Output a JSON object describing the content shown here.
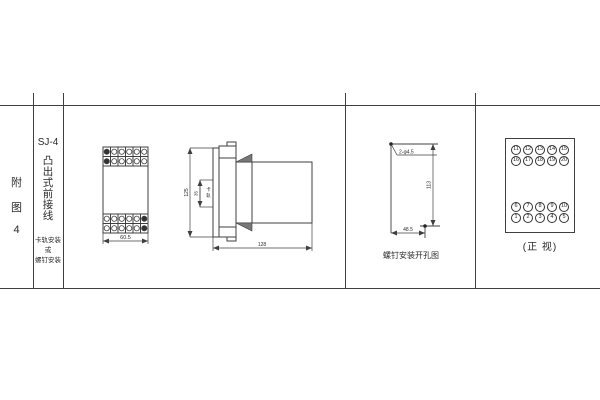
{
  "window": {
    "background": "#ffffff",
    "line_color": "#3f3f3f"
  },
  "sidebar": {
    "figure_label_chars": [
      "附",
      "图",
      "4"
    ],
    "model": "SJ-4",
    "type_chars": [
      "凸",
      "出",
      "式",
      "前",
      "接",
      "线"
    ],
    "mounting_lines": [
      "卡轨安装",
      "或",
      "螺钉安装"
    ]
  },
  "front_view": {
    "width_dim": "60.5"
  },
  "side_view": {
    "height_dim": "125",
    "rail_width_dim": "35",
    "rail_label_chars": [
      "卡",
      "轨"
    ],
    "depth_dim": "128"
  },
  "drill_view": {
    "holes_label": "2-φ4.5",
    "vertical_dim": "113",
    "horizontal_dim": "48.5",
    "caption": "螺钉安装开孔图"
  },
  "terminal_view": {
    "caption": "(正 视)",
    "rows": {
      "top1": [
        "11",
        "12",
        "13",
        "14",
        "15"
      ],
      "top2": [
        "16",
        "17",
        "18",
        "19",
        "20"
      ],
      "bottom1": [
        "6",
        "7",
        "8",
        "9",
        "10"
      ],
      "bottom2": [
        "1",
        "2",
        "3",
        "4",
        "5"
      ]
    }
  }
}
